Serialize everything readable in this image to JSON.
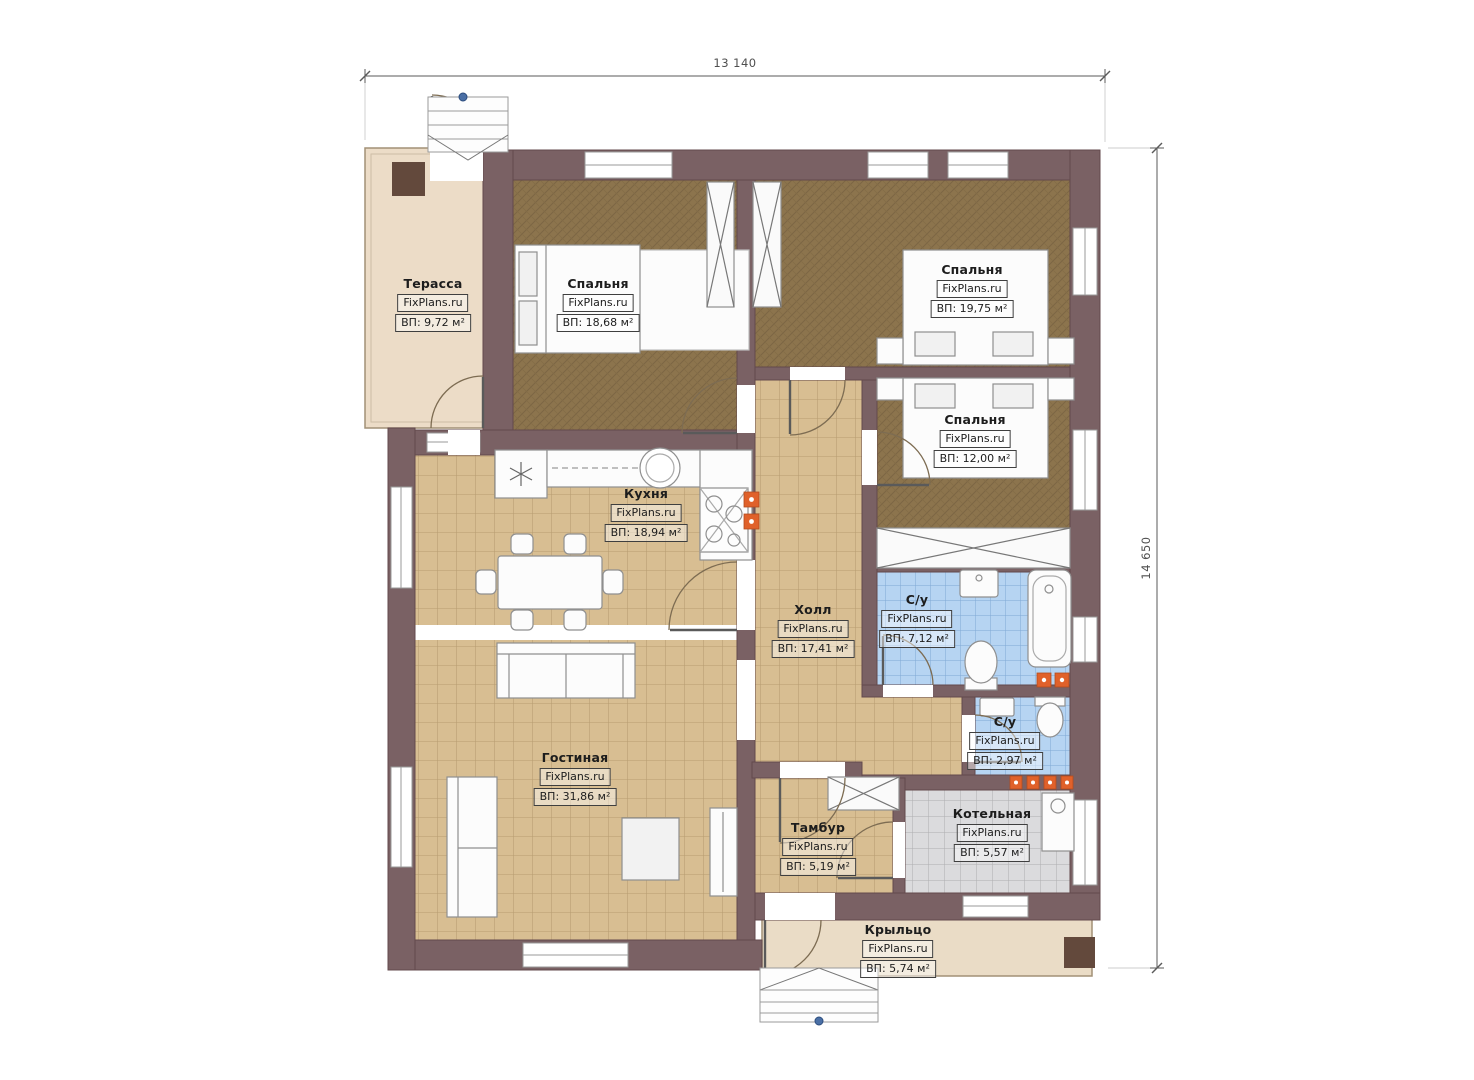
{
  "plan": {
    "type": "single-storey house floor plan",
    "watermark": "FixPlans.ru"
  },
  "dimensions": {
    "width_label": "13 140",
    "height_label": "14 650"
  },
  "rooms": [
    {
      "id": "terrace",
      "name": "Терасса",
      "site": "FixPlans.ru",
      "area": "ВП: 9,72 м²"
    },
    {
      "id": "bedroom-1",
      "name": "Спальня",
      "site": "FixPlans.ru",
      "area": "ВП: 18,68 м²"
    },
    {
      "id": "bedroom-2",
      "name": "Спальня",
      "site": "FixPlans.ru",
      "area": "ВП: 19,75 м²"
    },
    {
      "id": "bedroom-3",
      "name": "Спальня",
      "site": "FixPlans.ru",
      "area": "ВП: 12,00 м²"
    },
    {
      "id": "kitchen",
      "name": "Кухня",
      "site": "FixPlans.ru",
      "area": "ВП: 18,94 м²"
    },
    {
      "id": "hall",
      "name": "Холл",
      "site": "FixPlans.ru",
      "area": "ВП: 17,41 м²"
    },
    {
      "id": "bathroom-main",
      "name": "С/у",
      "site": "FixPlans.ru",
      "area": "ВП: 7,12 м²"
    },
    {
      "id": "bathroom-small",
      "name": "С/у",
      "site": "FixPlans.ru",
      "area": "ВП: 2,97 м²"
    },
    {
      "id": "living-room",
      "name": "Гостиная",
      "site": "FixPlans.ru",
      "area": "ВП: 31,86 м²"
    },
    {
      "id": "vestibule",
      "name": "Тамбур",
      "site": "FixPlans.ru",
      "area": "ВП: 5,19 м²"
    },
    {
      "id": "boiler-room",
      "name": "Котельная",
      "site": "FixPlans.ru",
      "area": "ВП: 5,57 м²"
    },
    {
      "id": "porch",
      "name": "Крыльцо",
      "site": "FixPlans.ru",
      "area": "ВП: 5,74 м²"
    }
  ],
  "colors": {
    "wall": "#7a6164",
    "tile_tan": "#d8be92",
    "tile_blue": "#b6d4f2",
    "tile_gray": "#dbdbdd",
    "floor_bedroom": "#8c744d",
    "terrace_cream": "#ecdcc7",
    "outlet_orange": "#e0612a"
  }
}
